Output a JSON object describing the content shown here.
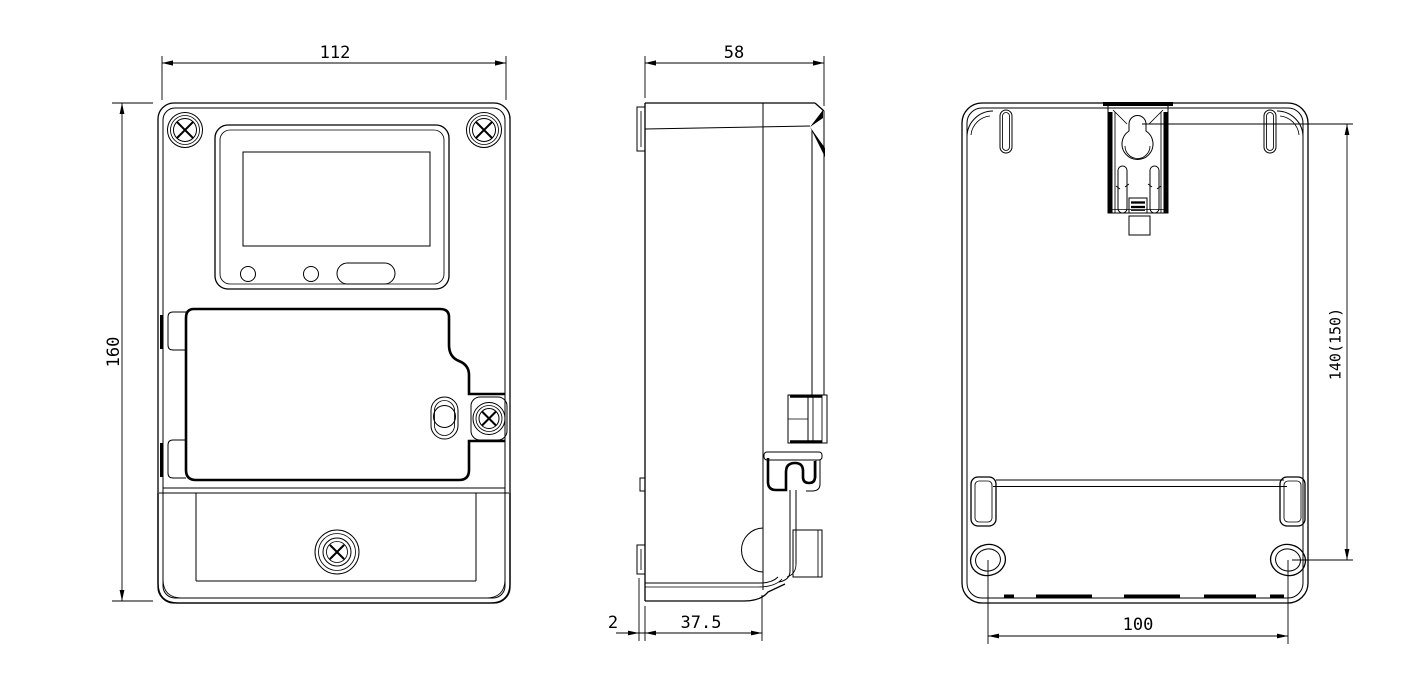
{
  "canvas": {
    "background": "#ffffff",
    "line_color": "#000000"
  },
  "dimensions": {
    "front_width": "112",
    "front_height": "160",
    "side_total_depth": "58",
    "side_front_lip": "2",
    "side_body_depth": "37.5",
    "rear_hanger_to_holes": "140(150)",
    "rear_hole_spacing": "100"
  }
}
